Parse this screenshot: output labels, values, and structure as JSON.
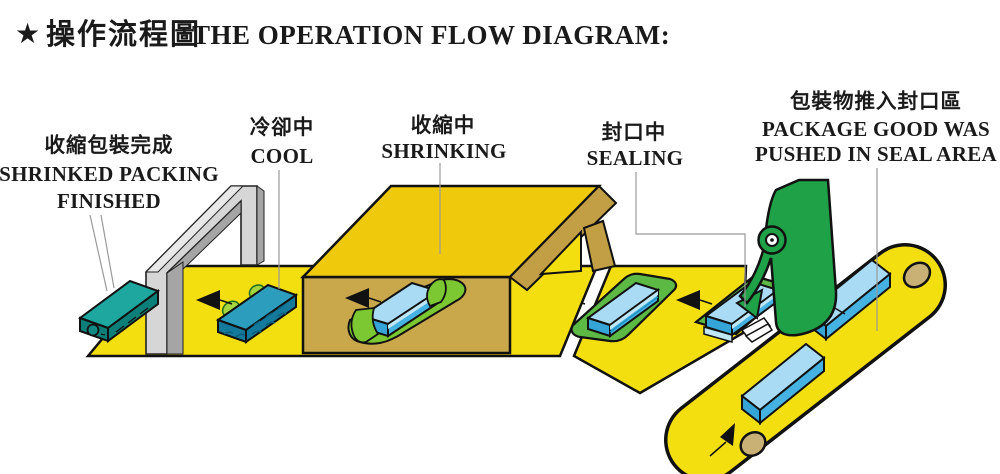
{
  "title": {
    "star": "★",
    "zh": "操作流程圖",
    "en": "THE OPERATION FLOW DIAGRAM:"
  },
  "stations": [
    {
      "id": "finished",
      "zh": "收縮包裝完成",
      "en_line1": "SHRINKED PACKING",
      "en_line2": "FINISHED"
    },
    {
      "id": "cool",
      "zh": "冷卻中",
      "en_line1": "COOL"
    },
    {
      "id": "shrinking",
      "zh": "收縮中",
      "en_line1": "SHRINKING"
    },
    {
      "id": "sealing",
      "zh": "封口中",
      "en_line1": "SEALING"
    },
    {
      "id": "infeed",
      "zh": "包裝物推入封口區",
      "en_line1": "PACKAGE GOOD WAS",
      "en_line2": "PUSHED IN SEAL AREA"
    }
  ],
  "colors": {
    "belt_yellow": "#F3DE10",
    "belt_outline": "#111111",
    "tunnel_top": "#EEC90C",
    "tunnel_front": "#C9A84B",
    "tunnel_wall": "#C29F45",
    "arch_light": "#D6D6D6",
    "arch_mid": "#E9E9E9",
    "arch_dark": "#A5A5A5",
    "teal_top": "#1EA79E",
    "teal_side": "#0C7F79",
    "cool_top": "#2D9DBE",
    "cool_side": "#147A9C",
    "blue_top": "#A9DBF4",
    "blue_side": "#45B2E2",
    "blue_end": "#35A5D8",
    "blue_light": "#BFE7F8",
    "film_green": "#1FA148",
    "film_light": "#7CC832",
    "tray_green": "#5CB944",
    "bump_green": "#A5D63F",
    "roller_tan": "#C9B176",
    "star_red": "#D7182A",
    "text_dark": "#1A1A1A",
    "leader_gray": "#9A9A9A"
  }
}
